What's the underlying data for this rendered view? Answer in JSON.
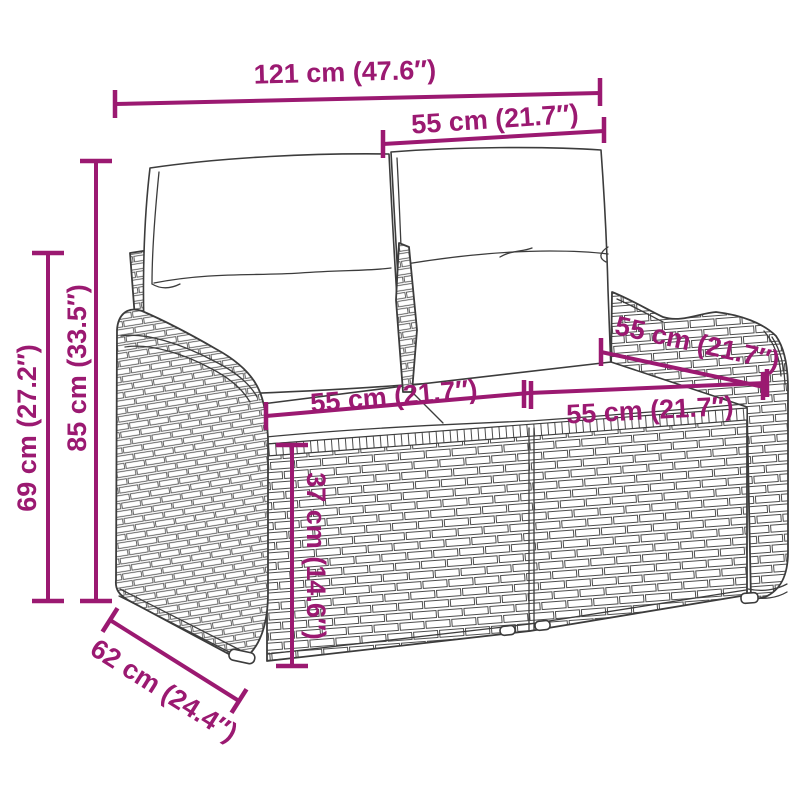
{
  "diagram": {
    "type": "product-dimension-diagram",
    "subject": "rattan-garden-bench-with-cushions",
    "dimensions": {
      "overall_width": "121 cm (47.6″)",
      "backrest_width": "55 cm (21.7″)",
      "overall_height": "85 cm (33.5″)",
      "armrest_height": "69 cm (27.2″)",
      "seat_width_left": "55 cm (21.7″)",
      "seat_width_right": "55 cm (21.7″)",
      "seat_depth": "55 cm (21.7″)",
      "seat_height": "37 cm (14.6″)",
      "base_depth": "62 cm (24.4″)"
    },
    "colors": {
      "dimension_accent": "#9B1971",
      "line_art": "#3C3C3C",
      "background": "#FFFFFF"
    }
  }
}
